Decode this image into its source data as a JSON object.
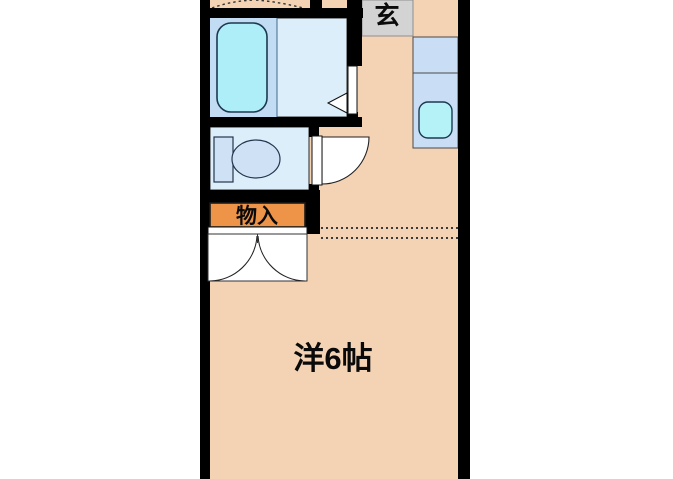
{
  "floorplan": {
    "kind": "apartment-floor-plan",
    "labels": {
      "entrance": "玄",
      "storage": "物入",
      "main_room": "洋6帖"
    },
    "colors": {
      "wall": "#000000",
      "floor": "#f4d3b4",
      "storage": "#ee9448",
      "entrance_tile": "#d3d3d3",
      "wet_room": "#ddeefb",
      "tub_deck": "#c2dcf3",
      "bathtub": "#aeeef8",
      "fixture": "#cfe1f4",
      "counter": "#c9def5",
      "sink": "#b5f2f8",
      "door": "#ffffff",
      "outline": "#1c3850"
    }
  }
}
